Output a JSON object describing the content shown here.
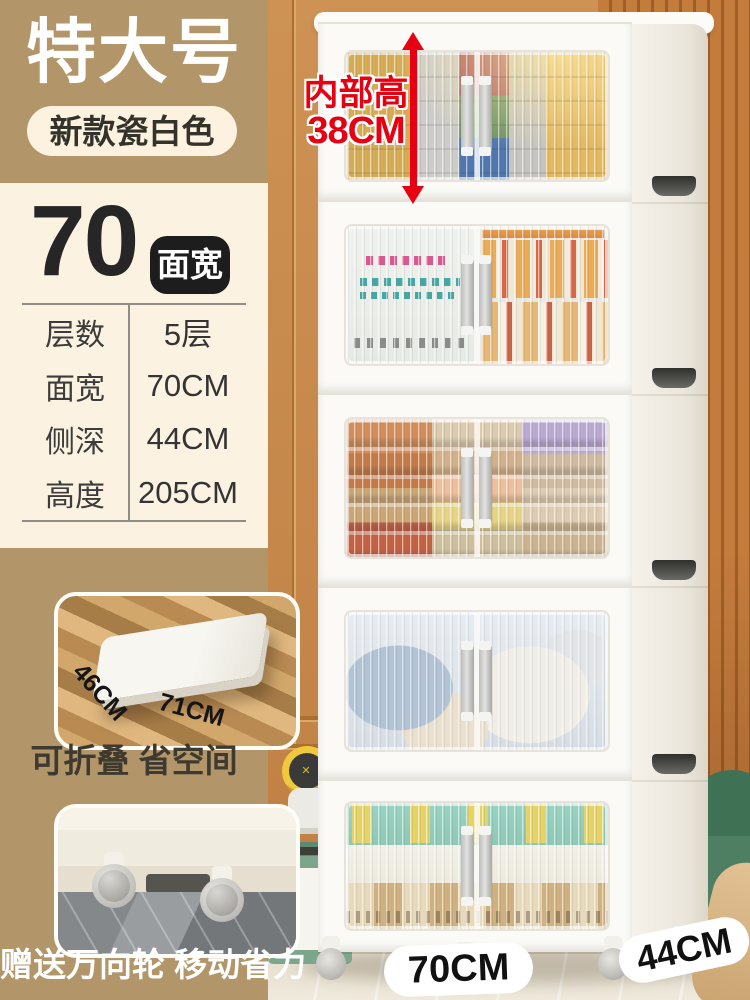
{
  "colors": {
    "accent_red": "#e60012",
    "sidebar_tan": "#b29669",
    "card_cream": "#fcf2e2",
    "badge_black": "#1d1d1d",
    "pill_cream": "#fcf2df"
  },
  "sidebar": {
    "size_title": "特大号",
    "color_badge": "新款瓷白色",
    "spec_card": {
      "width_number": "70",
      "width_badge_label": "面宽",
      "rows": [
        {
          "label": "层数",
          "value": "5层"
        },
        {
          "label": "面宽",
          "value": "70CM"
        },
        {
          "label": "侧深",
          "value": "44CM"
        },
        {
          "label": "高度",
          "value": "205CM"
        }
      ]
    },
    "fold_feature": {
      "caption": "可折叠 省空间",
      "depth_label": "46CM",
      "width_label": "71CM"
    },
    "wheel_feature": {
      "caption": "赠送万向轮 移动省力"
    }
  },
  "product_photo": {
    "inner_height_note": {
      "line1": "内部高",
      "line2": "38CM"
    },
    "front_width_label": "70CM",
    "side_depth_label": "44CM",
    "tier_count": "5"
  }
}
